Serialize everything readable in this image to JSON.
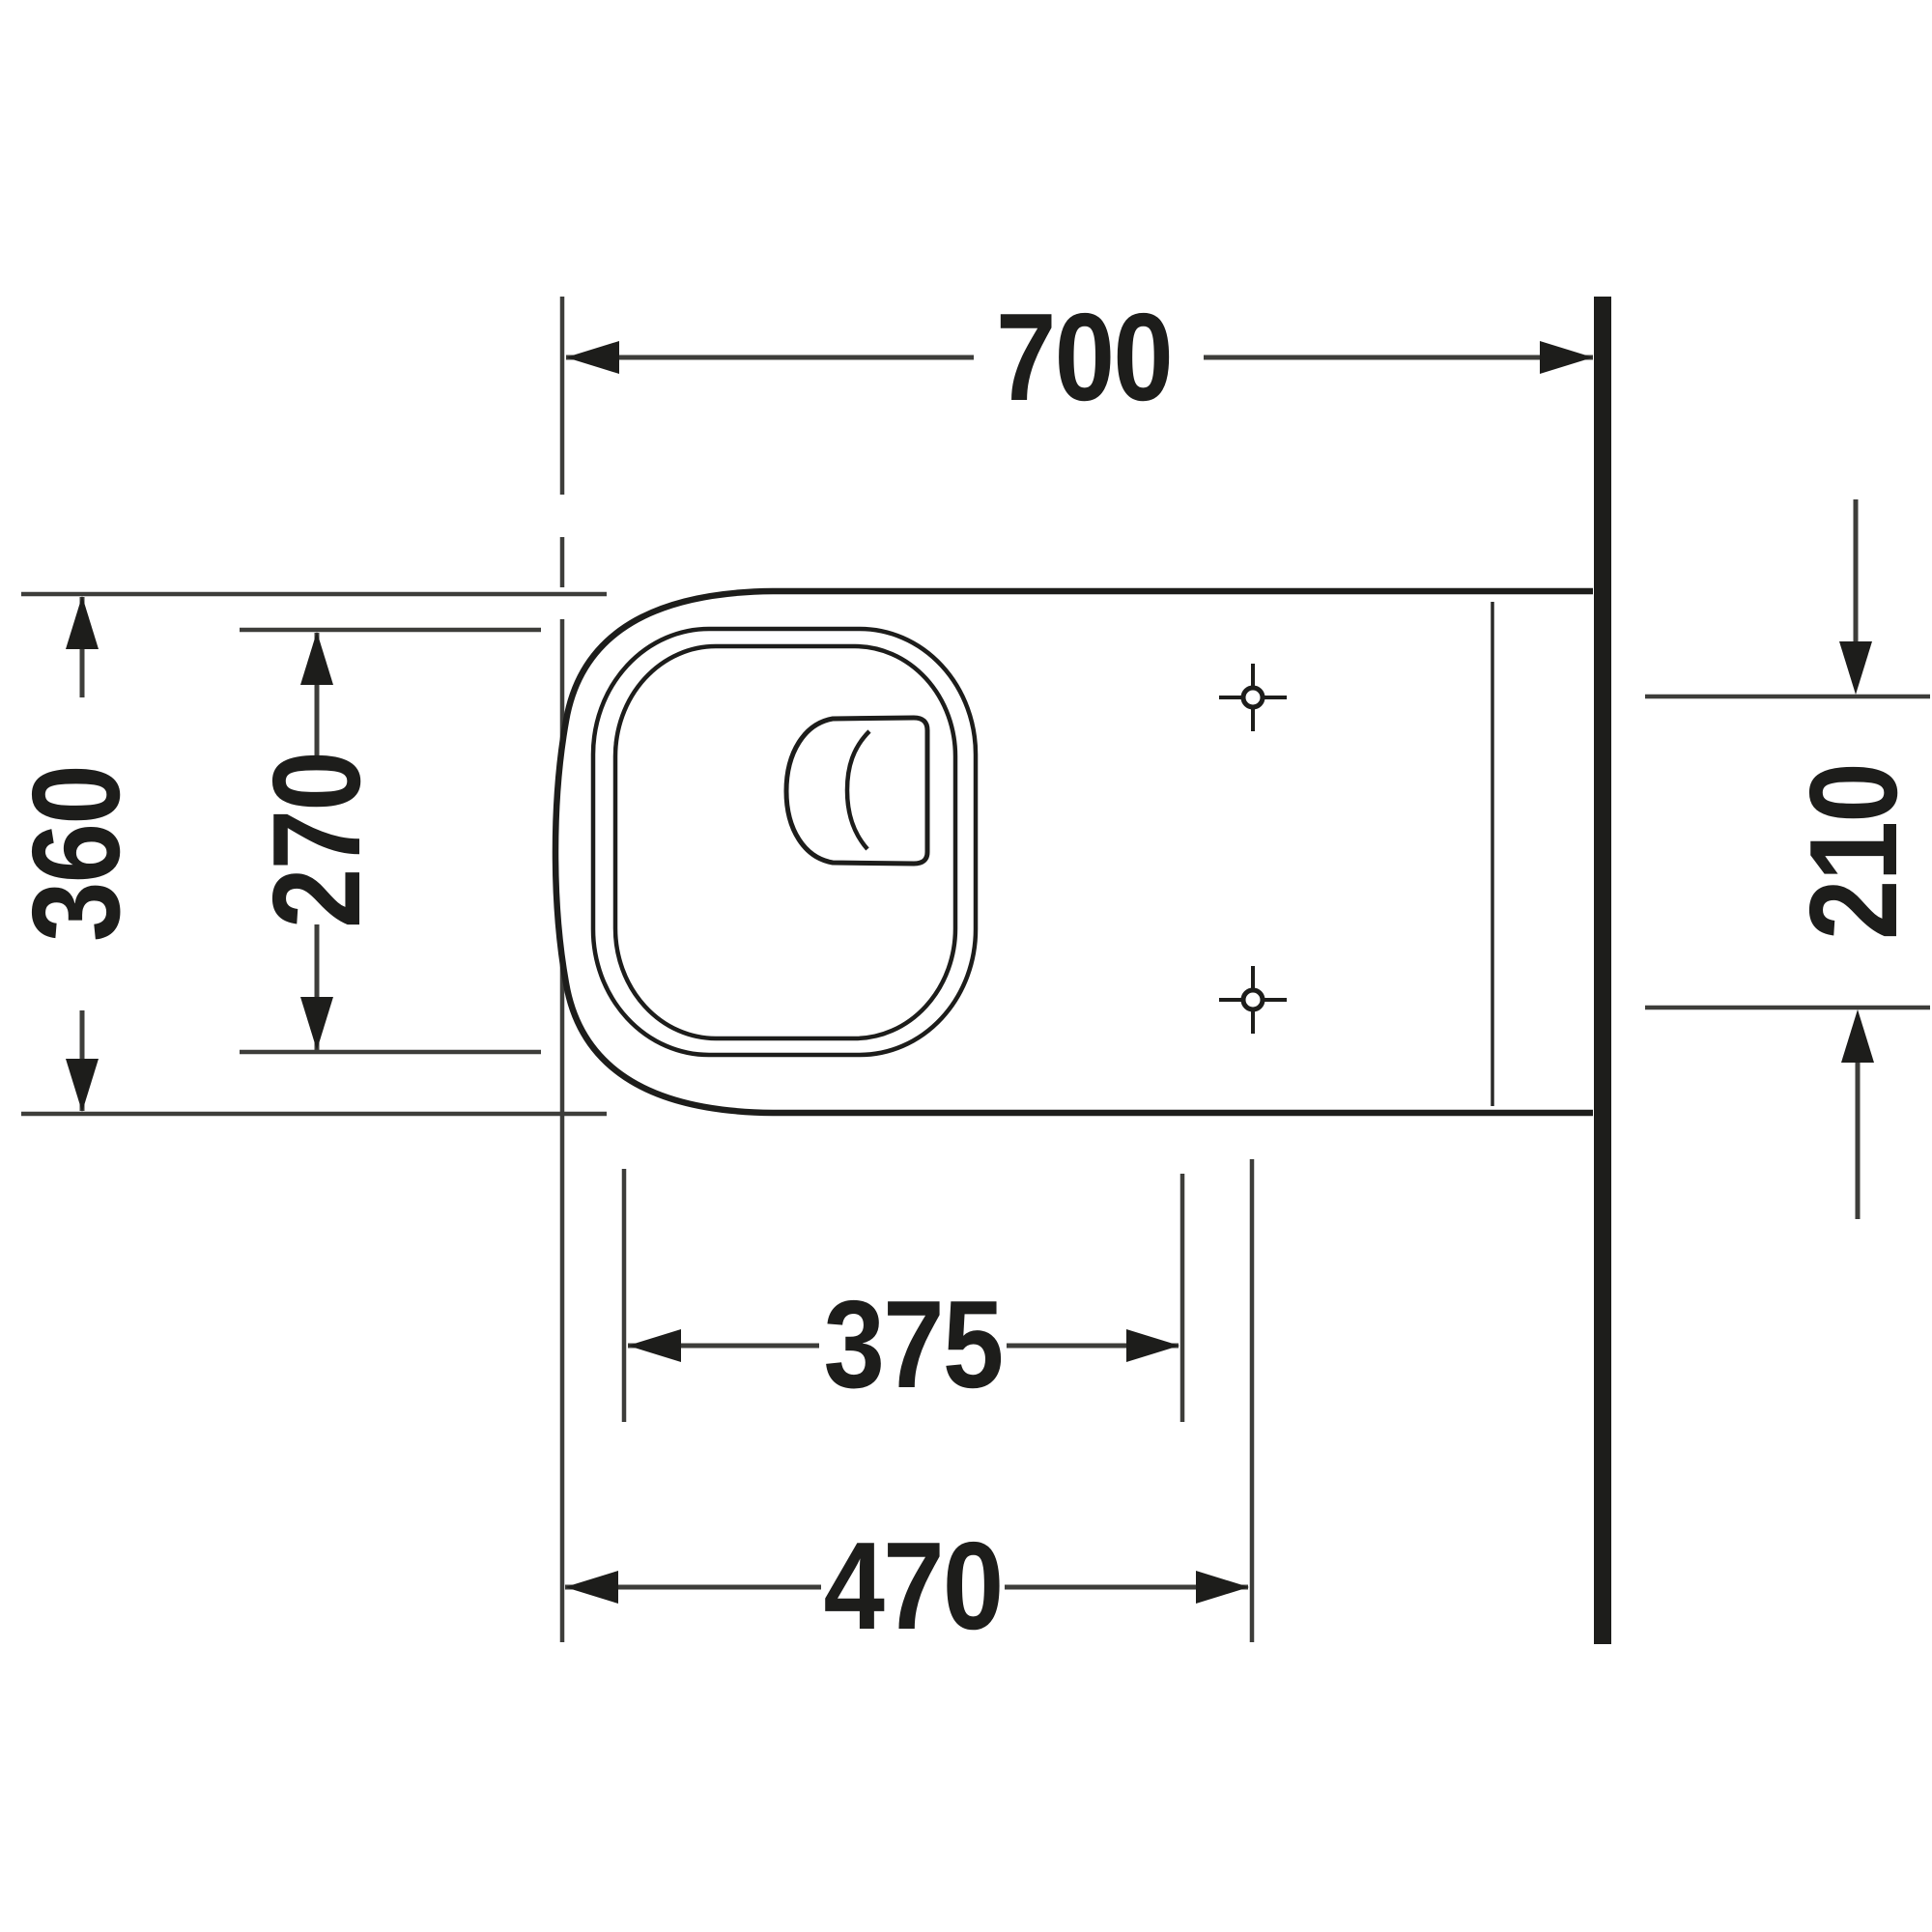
{
  "drawing": {
    "kind": "sanitary-ware plan view technical drawing",
    "colors": {
      "background": "#ffffff",
      "line_dark": "#1d1d1b",
      "line_mid": "#3d3d3a"
    },
    "dims": {
      "top": {
        "label": "700"
      },
      "left_outer": {
        "label": "360"
      },
      "left_inner": {
        "label": "270"
      },
      "right": {
        "label": "210"
      },
      "bottom_inner": {
        "label": "375"
      },
      "bottom_outer": {
        "label": "470"
      }
    }
  }
}
